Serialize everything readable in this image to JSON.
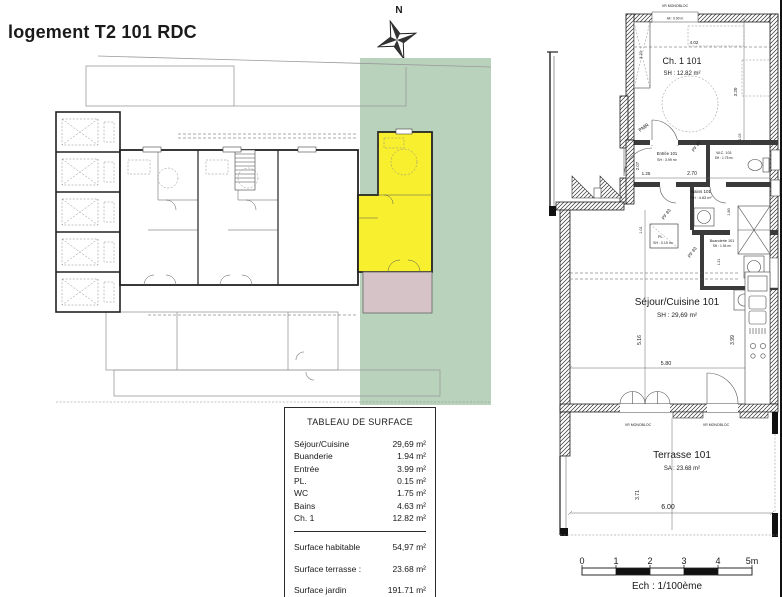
{
  "page": {
    "title": "logement T2 101 RDC"
  },
  "compass": {
    "north_label": "N"
  },
  "site_plan": {
    "garden_color": "#b9d2bc",
    "unit_highlight_color": "#f8ef2f",
    "terrace_color": "#d6c3c8"
  },
  "surface_table": {
    "title": "TABLEAU DE SURFACE",
    "rows": [
      {
        "label": "Séjour/Cuisine",
        "value": "29,69 m²"
      },
      {
        "label": "Buanderie",
        "value": "1.94 m²"
      },
      {
        "label": "Entrée",
        "value": "3.99 m²"
      },
      {
        "label": "PL.",
        "value": "0.15 m²"
      },
      {
        "label": "WC",
        "value": "1.75 m²"
      },
      {
        "label": "Bains",
        "value": "4.63 m²"
      },
      {
        "label": "Ch. 1",
        "value": "12.82 m²"
      }
    ],
    "totals": [
      {
        "label": "Surface habitable",
        "value": "54,97 m²"
      },
      {
        "label": "Surface terrasse :",
        "value": "23.68 m²"
      },
      {
        "label": "Surface jardin",
        "value": "191.71 m²"
      }
    ]
  },
  "floor_plan": {
    "window_labels": {
      "top": "VR MONOBLOC",
      "sill": "All : 0.90 m",
      "sejour_left": "VR MONOBLOC",
      "sejour_right": "VR MONOBLOC"
    },
    "rooms": {
      "ch1": {
        "name": "Ch. 1 101",
        "area": "SH : 12.82 m²"
      },
      "entree": {
        "name": "Entrée 101",
        "area": "SH : 3.99 m²"
      },
      "wc": {
        "name": "W.C. 101",
        "area": "SH : 1.75 m²"
      },
      "bains": {
        "name": "Bains 101",
        "area": "SH : 4.63 m²"
      },
      "pl": {
        "name": "PL.",
        "area": "SH : 0.15 m²"
      },
      "buanderie": {
        "name": "Buanderie 101",
        "area": "SH : 1.94 m²"
      },
      "sejour": {
        "name": "Séjour/Cuisine 101",
        "area": "SH : 29,69 m²"
      },
      "terrasse": {
        "name": "Terrasse 101",
        "area": "SA : 23.68 m²"
      }
    },
    "dimensions": {
      "ch1_width": "4.02",
      "ch1_closet_h": "3.20",
      "ch1_room_h": "3.20",
      "entree_h": "2.07",
      "entree_w": "1.25",
      "hall_w": "2.70",
      "wc_side": "1.03",
      "bains_side": "1.80",
      "pl_h": "1.01",
      "buanderie_h": "1.21",
      "sejour_h": "5.16",
      "sejour_w": "5.80",
      "kitchen_h": "3.99",
      "terrasse_h": "3.71",
      "terrasse_w": "6.00"
    },
    "door_labels": {
      "d1": "PF 83",
      "d2": "PF 83",
      "d3": "PF 83"
    },
    "pmr_label": "PMR"
  },
  "scale_bar": {
    "ticks": [
      "0",
      "1",
      "2",
      "3",
      "4",
      "5m"
    ],
    "caption": "Ech : 1/100ème"
  }
}
